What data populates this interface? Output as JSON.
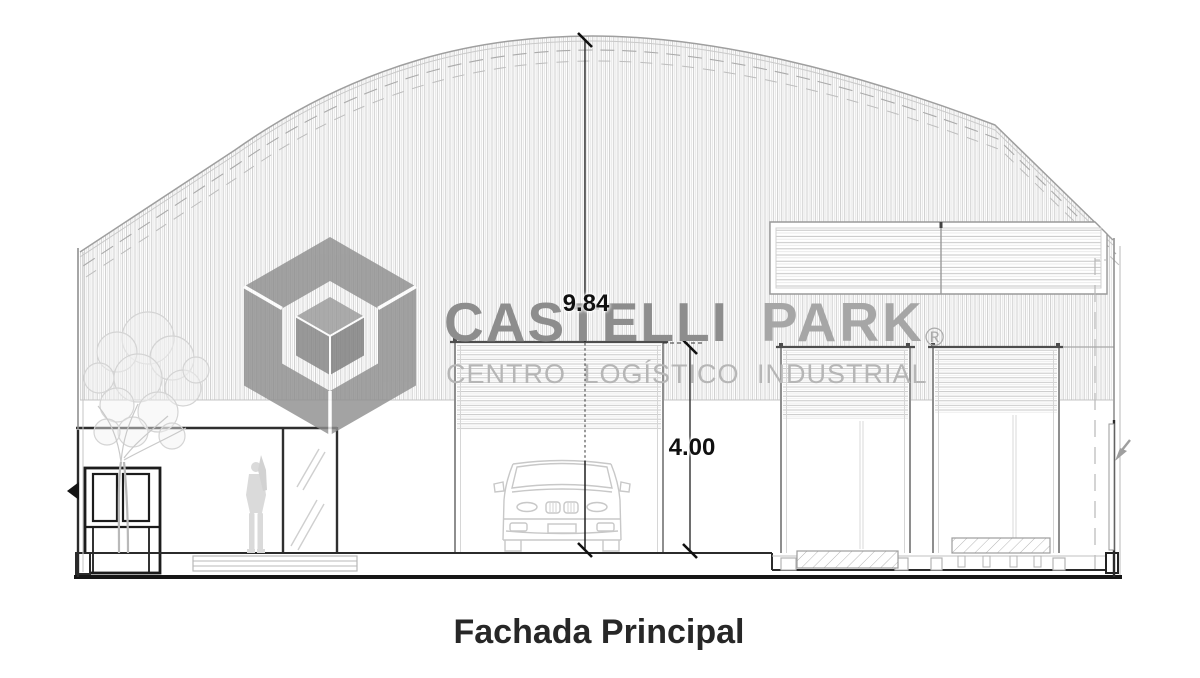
{
  "title_block": {
    "caption": "Fachada Principal"
  },
  "watermark": {
    "brand_primary": "CASTELLI",
    "brand_secondary": "PARK",
    "registered_symbol": "®",
    "tagline": "CENTRO LOGÍSTICO INDUSTRIAL",
    "logo_icon": "isometric-cube-logo",
    "colors": {
      "brand_primary": "#8d8d8d",
      "brand_secondary": "#a6a6a6",
      "tagline": "#b6b6b6",
      "logo": "#8f8f8f"
    }
  },
  "annotations": {
    "dimension_color": "#101010",
    "dimensions": [
      {
        "id": "ridge-height",
        "value": "9.84"
      },
      {
        "id": "door-height",
        "value": "4.00"
      }
    ]
  },
  "drawing": {
    "line_color_dark": "#1c1c1c",
    "line_color_light": "#c6c6c6",
    "elements": [
      "arched-roof-shell",
      "vertical-cladding-hatch",
      "louver-panel",
      "roller-door-center",
      "roller-door-mid",
      "roller-door-right",
      "guard-kiosk",
      "glass-entry-door",
      "security-guard-figure",
      "tree",
      "suv-front-view",
      "loading-dock-ramp",
      "loading-dock-platform",
      "bench",
      "ground-baseline"
    ]
  }
}
